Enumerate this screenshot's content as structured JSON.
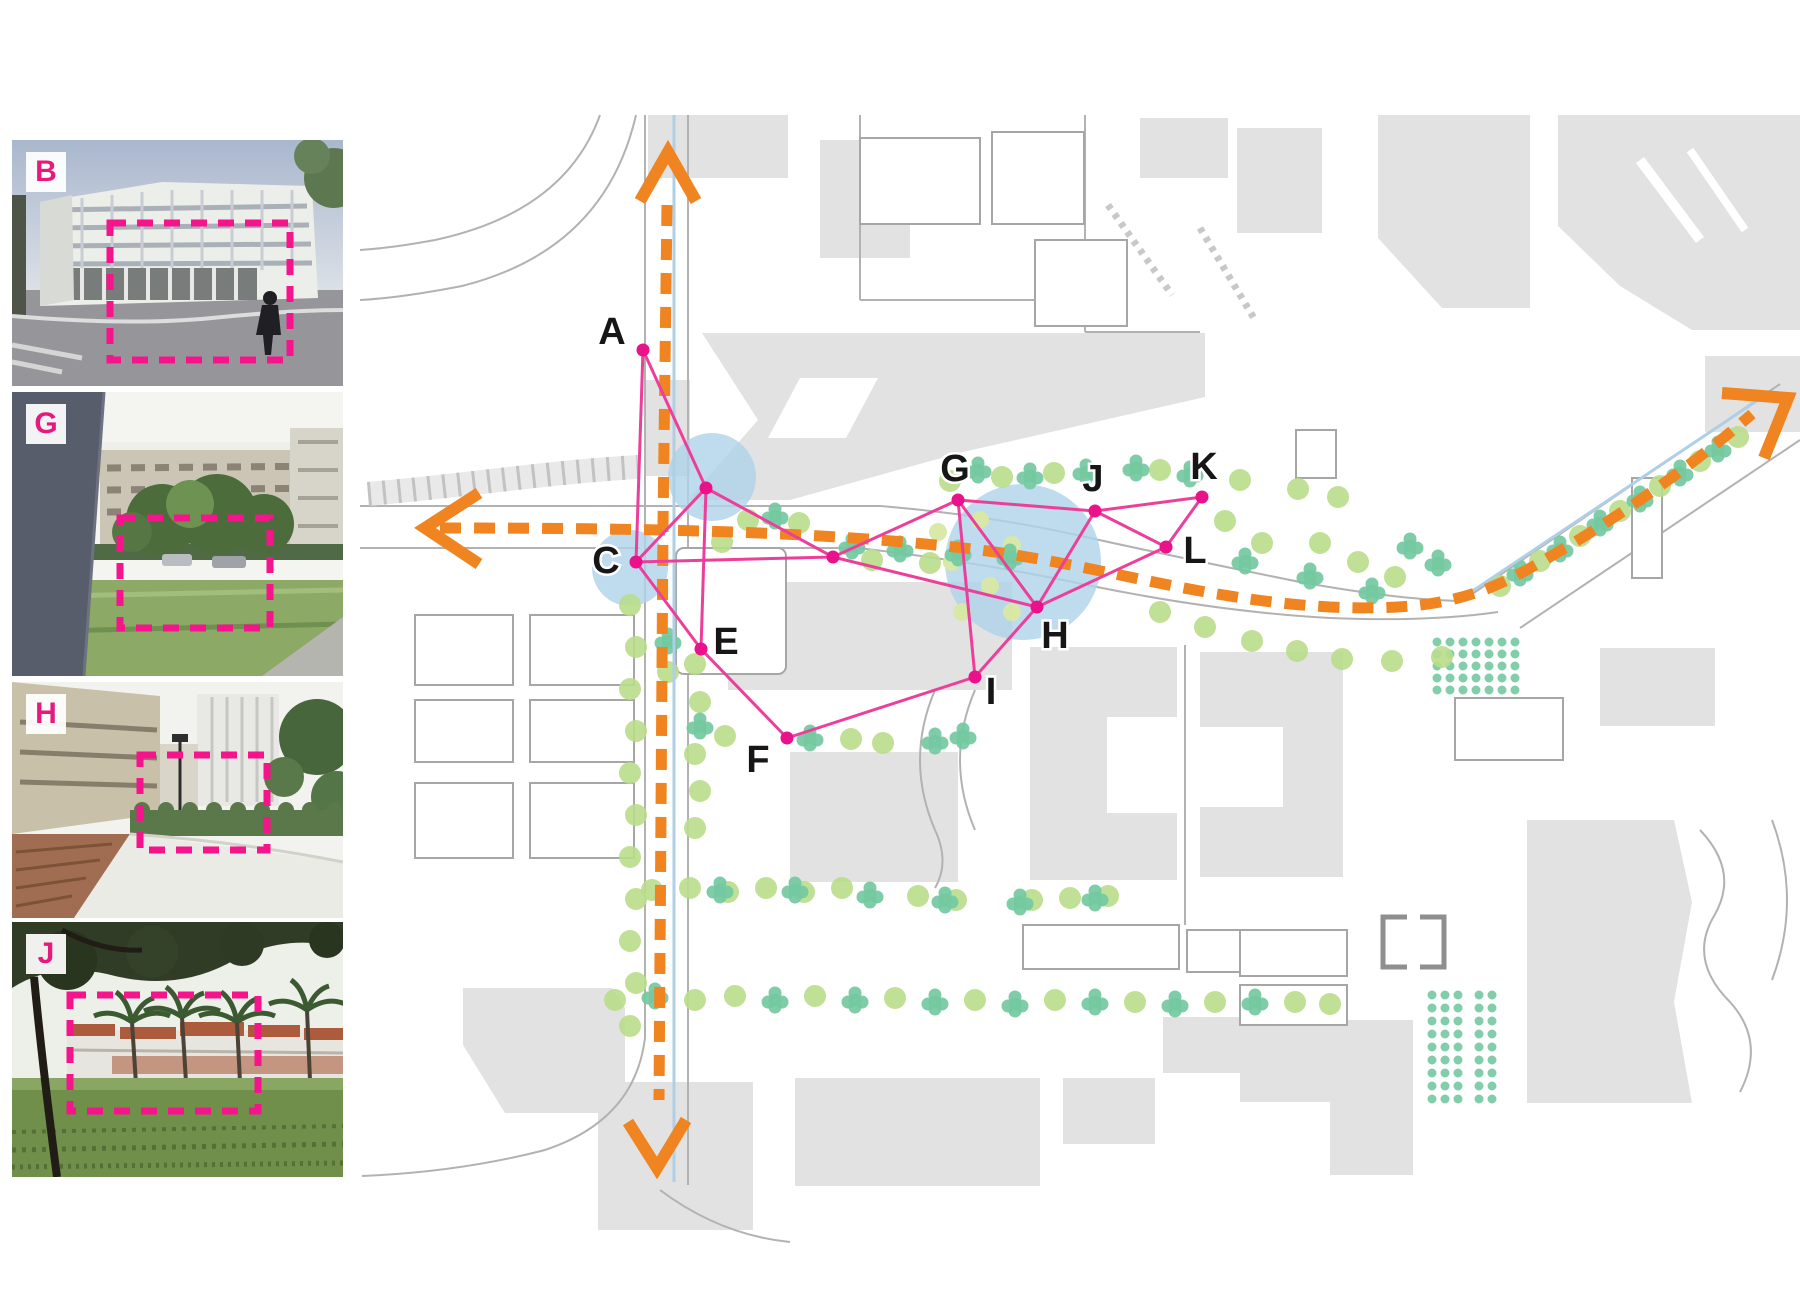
{
  "figure": {
    "title": "campus photo-location map figure"
  },
  "photos": [
    {
      "id": "B",
      "label": "B"
    },
    {
      "id": "G",
      "label": "G"
    },
    {
      "id": "H",
      "label": "H"
    },
    {
      "id": "J",
      "label": "J"
    }
  ],
  "map": {
    "colors": {
      "building": "#e2e2e2",
      "road": "#b2b2b2",
      "orange": "#ef8420",
      "pink_edge": "#ec3f9b",
      "pink_node": "#e9128a",
      "blue_circle": "#aed3e8",
      "blue_line": "#aecfe6",
      "tree_light": "#b9dd8b",
      "tree_teal": "#74c9a1",
      "tree_pale": "#d8e8a4",
      "photo_label": "#e8197d",
      "dashed_box": "#f5148c",
      "map_label": "#161616"
    },
    "buildings": {
      "rects": [
        [
          648,
          115,
          140,
          63
        ],
        [
          820,
          140,
          90,
          118
        ],
        [
          1140,
          118,
          88,
          60
        ],
        [
          1237,
          128,
          85,
          105
        ],
        [
          646,
          380,
          44,
          96
        ],
        [
          728,
          582,
          284,
          108
        ],
        [
          790,
          752,
          168,
          130
        ],
        [
          1030,
          647,
          147,
          233
        ],
        [
          1200,
          652,
          143,
          225
        ],
        [
          598,
          1082,
          155,
          148
        ],
        [
          795,
          1078,
          245,
          108
        ],
        [
          1600,
          648,
          115,
          78
        ],
        [
          1163,
          1017,
          118,
          56
        ],
        [
          1063,
          1078,
          92,
          66
        ]
      ],
      "polys": [
        [
          [
            1378,
            115
          ],
          [
            1530,
            115
          ],
          [
            1530,
            308
          ],
          [
            1442,
            308
          ],
          [
            1378,
            238
          ]
        ],
        [
          [
            1558,
            115
          ],
          [
            1800,
            115
          ],
          [
            1800,
            330
          ],
          [
            1692,
            330
          ],
          [
            1620,
            286
          ],
          [
            1558,
            226
          ]
        ],
        [
          [
            1705,
            356
          ],
          [
            1800,
            356
          ],
          [
            1800,
            432
          ],
          [
            1705,
            432
          ]
        ],
        [
          [
            688,
            500
          ],
          [
            758,
            420
          ],
          [
            702,
            333
          ],
          [
            1205,
            333
          ],
          [
            1205,
            397
          ],
          [
            963,
            452
          ],
          [
            790,
            500
          ]
        ],
        [
          [
            463,
            988
          ],
          [
            612,
            988
          ],
          [
            625,
            1008
          ],
          [
            625,
            1113
          ],
          [
            505,
            1113
          ],
          [
            463,
            1045
          ]
        ],
        [
          [
            1240,
            1020
          ],
          [
            1413,
            1020
          ],
          [
            1413,
            1175
          ],
          [
            1330,
            1175
          ],
          [
            1330,
            1102
          ],
          [
            1240,
            1102
          ]
        ],
        [
          [
            1527,
            820
          ],
          [
            1674,
            820
          ],
          [
            1692,
            902
          ],
          [
            1674,
            1002
          ],
          [
            1692,
            1103
          ],
          [
            1527,
            1103
          ]
        ]
      ]
    },
    "notches": {
      "rects": [
        [
          1107,
          717,
          70,
          96
        ],
        [
          1200,
          727,
          83,
          80
        ]
      ],
      "polys": [
        [
          [
            800,
            378
          ],
          [
            878,
            378
          ],
          [
            846,
            438
          ],
          [
            768,
            438
          ]
        ]
      ]
    },
    "outlined": [
      [
        860,
        138,
        120,
        86,
        0
      ],
      [
        992,
        132,
        92,
        92,
        0
      ],
      [
        1035,
        240,
        92,
        86,
        0
      ],
      [
        676,
        548,
        110,
        126,
        8
      ],
      [
        415,
        615,
        98,
        70,
        0
      ],
      [
        530,
        615,
        104,
        70,
        0
      ],
      [
        415,
        700,
        98,
        62,
        0
      ],
      [
        530,
        700,
        104,
        62,
        0
      ],
      [
        415,
        783,
        98,
        75,
        0
      ],
      [
        530,
        783,
        104,
        75,
        0
      ],
      [
        1023,
        925,
        156,
        44,
        0
      ],
      [
        1187,
        930,
        138,
        42,
        0
      ],
      [
        1240,
        930,
        107,
        46,
        0
      ],
      [
        1240,
        985,
        107,
        40,
        0
      ],
      [
        1632,
        478,
        30,
        100,
        0
      ],
      [
        1455,
        698,
        108,
        62,
        0
      ],
      [
        1296,
        430,
        40,
        48,
        0
      ]
    ],
    "brackets": [
      "M1407,917 h-24 v50 h24",
      "M1420,917 h24 v50 h-24"
    ],
    "roads": [
      {
        "d": "M645,115 V1038 Q635,1120 545,1150 Q460,1172 362,1176"
      },
      {
        "d": "M688,115 V1185"
      },
      {
        "d": "M360,506 H690"
      },
      {
        "d": "M702,506 H880 Q990,515 1090,538 Q1200,562 1300,582 Q1400,600 1462,601"
      },
      {
        "d": "M360,548 H640"
      },
      {
        "d": "M700,548 H858 Q980,562 1092,586 Q1220,612 1330,618 Q1430,622 1498,612"
      },
      {
        "d": "M1462,601 L1780,384"
      },
      {
        "d": "M1520,628 L1800,440"
      },
      {
        "d": "M600,115 Q565,212 435,240 Q392,248 360,250"
      },
      {
        "d": "M636,115 Q605,250 462,286 Q400,298 360,300"
      },
      {
        "d": "M860,115 V300 M860,300 H1085 M1085,115 V332 M1085,332 H1200"
      },
      {
        "d": "M1185,645 V925"
      },
      {
        "d": "M935,690 Q905,760 935,830 Q950,862 935,888"
      },
      {
        "d": "M975,690 Q945,760 975,830"
      },
      {
        "d": "M660,1190 Q720,1235 790,1242"
      },
      {
        "d": "M1700,830 Q1740,872 1714,916 Q1688,960 1730,1002 Q1766,1042 1740,1092"
      },
      {
        "d": "M1772,820 Q1802,900 1772,980"
      },
      {
        "d": "M1640,160 L1700,240",
        "c": "#ffffff",
        "w": 10
      },
      {
        "d": "M1690,150 L1745,230",
        "c": "#ffffff",
        "w": 8
      },
      {
        "d": "M368,494 C460,486 560,471 638,467",
        "c": "#e9e9e9",
        "w": 24
      },
      {
        "d": "M368,494 C460,486 560,471 638,467",
        "c": "#c2c2c2",
        "w": 24,
        "dash": "3 12"
      },
      {
        "d": "M1108,205 L1172,295",
        "c": "#c8c8c8",
        "w": 7,
        "dash": "5 6"
      },
      {
        "d": "M1200,228 L1255,320",
        "c": "#c8c8c8",
        "w": 7,
        "dash": "5 6"
      }
    ],
    "blue_lines": [
      "M674,115 V1182",
      "M1468,594 L1764,396"
    ],
    "blue_circles": [
      [
        712,
        477,
        44
      ],
      [
        630,
        568,
        38
      ],
      [
        1023,
        562,
        78
      ]
    ],
    "grids": [
      {
        "x": 1437,
        "y": 642,
        "cols": 7,
        "rows": 5,
        "dx": 13,
        "dy": 12,
        "r": 4.5
      },
      {
        "x": 1432,
        "y": 995,
        "cols": 3,
        "rows": 9,
        "dx": 13,
        "dy": 13,
        "r": 4.5
      },
      {
        "x": 1479,
        "y": 995,
        "cols": 2,
        "rows": 9,
        "dx": 13,
        "dy": 13,
        "r": 4.5
      }
    ],
    "trees": {
      "light": [
        [
          748,
          520
        ],
        [
          799,
          523
        ],
        [
          722,
          542
        ],
        [
          950,
          481
        ],
        [
          1002,
          477
        ],
        [
          1054,
          473
        ],
        [
          1160,
          470
        ],
        [
          1240,
          480
        ],
        [
          1298,
          489
        ],
        [
          1338,
          497
        ],
        [
          1225,
          521
        ],
        [
          1262,
          543
        ],
        [
          1320,
          543
        ],
        [
          1358,
          562
        ],
        [
          1395,
          577
        ],
        [
          872,
          560
        ],
        [
          930,
          563
        ],
        [
          1160,
          612
        ],
        [
          1205,
          627
        ],
        [
          1252,
          641
        ],
        [
          1297,
          651
        ],
        [
          1342,
          659
        ],
        [
          1392,
          661
        ],
        [
          1442,
          657
        ],
        [
          630,
          605
        ],
        [
          636,
          647
        ],
        [
          630,
          689
        ],
        [
          636,
          731
        ],
        [
          630,
          773
        ],
        [
          636,
          815
        ],
        [
          630,
          857
        ],
        [
          636,
          899
        ],
        [
          630,
          941
        ],
        [
          636,
          983
        ],
        [
          630,
          1026
        ],
        [
          695,
          664
        ],
        [
          700,
          702
        ],
        [
          695,
          754
        ],
        [
          700,
          791
        ],
        [
          695,
          828
        ],
        [
          725,
          736
        ],
        [
          851,
          739
        ],
        [
          883,
          743
        ],
        [
          652,
          890
        ],
        [
          690,
          888
        ],
        [
          728,
          892
        ],
        [
          766,
          888
        ],
        [
          804,
          892
        ],
        [
          842,
          888
        ],
        [
          918,
          896
        ],
        [
          956,
          900
        ],
        [
          1032,
          900
        ],
        [
          1070,
          898
        ],
        [
          1108,
          896
        ],
        [
          615,
          1000
        ],
        [
          695,
          1000
        ],
        [
          735,
          996
        ],
        [
          815,
          996
        ],
        [
          895,
          998
        ],
        [
          975,
          1000
        ],
        [
          1055,
          1000
        ],
        [
          1135,
          1002
        ],
        [
          1215,
          1002
        ],
        [
          1295,
          1002
        ],
        [
          1330,
          1004
        ],
        [
          1500,
          586
        ],
        [
          1540,
          561
        ],
        [
          1580,
          536
        ],
        [
          1620,
          511
        ],
        [
          1660,
          486
        ],
        [
          1700,
          461
        ],
        [
          1738,
          437
        ],
        [
          668,
          672
        ]
      ],
      "teal": [
        [
          775,
          516
        ],
        [
          852,
          546
        ],
        [
          978,
          470
        ],
        [
          1030,
          476
        ],
        [
          1086,
          472
        ],
        [
          1136,
          468
        ],
        [
          1190,
          474
        ],
        [
          900,
          549
        ],
        [
          958,
          553
        ],
        [
          1010,
          557
        ],
        [
          1245,
          561
        ],
        [
          1310,
          576
        ],
        [
          1372,
          591
        ],
        [
          700,
          726
        ],
        [
          668,
          641
        ],
        [
          810,
          738
        ],
        [
          935,
          741
        ],
        [
          963,
          736
        ],
        [
          720,
          890
        ],
        [
          795,
          890
        ],
        [
          870,
          895
        ],
        [
          945,
          900
        ],
        [
          1020,
          902
        ],
        [
          1095,
          898
        ],
        [
          655,
          996
        ],
        [
          775,
          1000
        ],
        [
          855,
          1000
        ],
        [
          935,
          1002
        ],
        [
          1015,
          1004
        ],
        [
          1095,
          1002
        ],
        [
          1175,
          1004
        ],
        [
          1255,
          1002
        ],
        [
          1520,
          573
        ],
        [
          1560,
          549
        ],
        [
          1600,
          523
        ],
        [
          1640,
          499
        ],
        [
          1680,
          473
        ],
        [
          1718,
          449
        ],
        [
          1410,
          546
        ],
        [
          1438,
          563
        ]
      ],
      "pale": [
        [
          980,
          520
        ],
        [
          1012,
          545
        ],
        [
          952,
          562
        ],
        [
          990,
          586
        ],
        [
          962,
          612
        ],
        [
          1012,
          612
        ],
        [
          938,
          532
        ]
      ]
    },
    "orange": {
      "routes": [
        "M667,205 L663,525 L659,1100",
        "M440,528 C700,528 850,534 980,550 C1100,565 1200,600 1330,607 C1425,611 1472,601 1532,567 C1622,517 1700,459 1752,414"
      ],
      "arrows": [
        "M640,201 L668,152 L696,201",
        "M628,1122 L657,1168 L686,1120",
        "M479,493 L425,528 L479,564",
        "M1722,393 L1788,398 L1764,458"
      ]
    },
    "network": {
      "nodes": [
        {
          "id": "A",
          "label": "A",
          "x": 643,
          "y": 350,
          "lx": 612,
          "ly": 332
        },
        {
          "id": "C",
          "label": "C",
          "x": 636,
          "y": 562,
          "lx": 606,
          "ly": 561
        },
        {
          "id": "E",
          "label": "E",
          "x": 701,
          "y": 649,
          "lx": 726,
          "ly": 642
        },
        {
          "id": "F",
          "label": "F",
          "x": 787,
          "y": 738,
          "lx": 758,
          "ly": 760
        },
        {
          "id": "G",
          "label": "G",
          "x": 958,
          "y": 500,
          "lx": 955,
          "ly": 469
        },
        {
          "id": "H",
          "label": "H",
          "x": 1037,
          "y": 607,
          "lx": 1055,
          "ly": 636
        },
        {
          "id": "I",
          "label": "I",
          "x": 975,
          "y": 677,
          "lx": 991,
          "ly": 692
        },
        {
          "id": "J",
          "label": "J",
          "x": 1095,
          "y": 511,
          "lx": 1093,
          "ly": 479
        },
        {
          "id": "K",
          "label": "K",
          "x": 1202,
          "y": 497,
          "lx": 1204,
          "ly": 467
        },
        {
          "id": "L",
          "label": "L",
          "x": 1166,
          "y": 547,
          "lx": 1195,
          "ly": 551
        },
        {
          "id": "X1",
          "x": 706,
          "y": 488
        },
        {
          "id": "X2",
          "x": 833,
          "y": 557
        }
      ],
      "edges": [
        [
          "A",
          "X1"
        ],
        [
          "A",
          "C"
        ],
        [
          "C",
          "X1"
        ],
        [
          "X1",
          "X2"
        ],
        [
          "X1",
          "E"
        ],
        [
          "C",
          "X2"
        ],
        [
          "C",
          "E"
        ],
        [
          "E",
          "F"
        ],
        [
          "F",
          "I"
        ],
        [
          "I",
          "H"
        ],
        [
          "I",
          "G"
        ],
        [
          "X2",
          "G"
        ],
        [
          "X2",
          "H"
        ],
        [
          "G",
          "H"
        ],
        [
          "G",
          "J"
        ],
        [
          "J",
          "H"
        ],
        [
          "J",
          "K"
        ],
        [
          "J",
          "L"
        ],
        [
          "K",
          "L"
        ],
        [
          "L",
          "H"
        ]
      ]
    }
  }
}
